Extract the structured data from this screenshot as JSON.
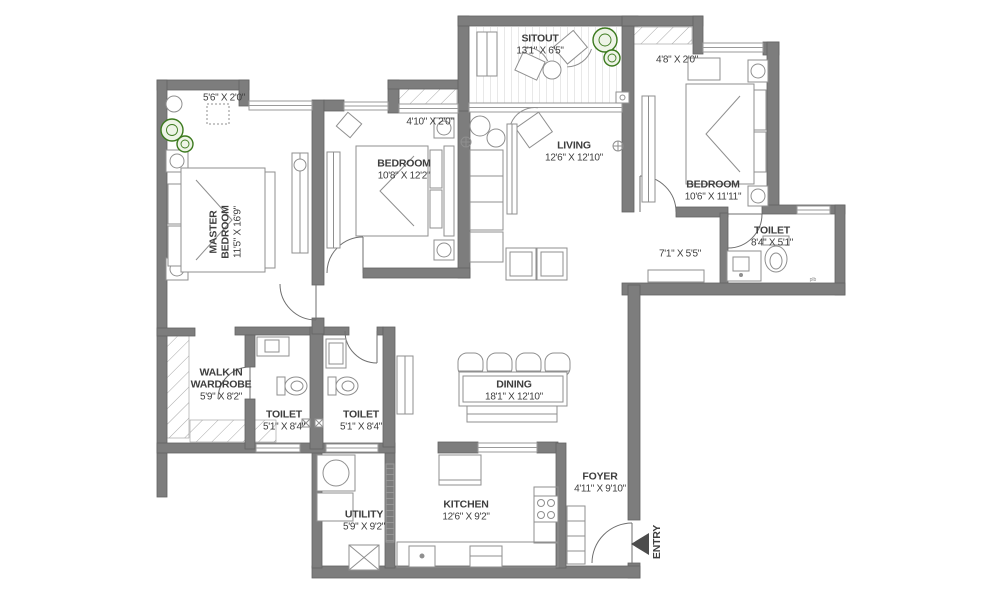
{
  "title": "Apartment floor plan",
  "rooms": {
    "master_bedroom": {
      "name": "MASTER BEDROOM",
      "dims": "11'5\" X 16'9\""
    },
    "bedroom_2": {
      "name": "BEDROOM",
      "dims": "10'8\" X 12'2\""
    },
    "bedroom_3": {
      "name": "BEDROOM",
      "dims": "10'6\" X 11'11\""
    },
    "living": {
      "name": "LIVING",
      "dims": "12'6\" X 12'10\""
    },
    "sitout": {
      "name": "SITOUT",
      "dims": "13'1\" X 6'5\""
    },
    "dining": {
      "name": "DINING",
      "dims": "18'1\" X 12'10\""
    },
    "kitchen": {
      "name": "KITCHEN",
      "dims": "12'6\" X 9'2\""
    },
    "utility": {
      "name": "UTILITY",
      "dims": "5'9\" X 9'2\""
    },
    "foyer": {
      "name": "FOYER",
      "dims": "4'11\" X 9'10\""
    },
    "walk_in_wardrobe": {
      "name": "WALK IN WARDROBE",
      "dims": "5'9\" X 8'2\""
    },
    "toilet_1": {
      "name": "TOILET",
      "dims": "5'1\" X 8'4\""
    },
    "toilet_2": {
      "name": "TOILET",
      "dims": "5'1\" X 8'4\""
    },
    "toilet_3": {
      "name": "TOILET",
      "dims": "8'4\" X 5'1\""
    },
    "passage": {
      "dims": "7'1\" X 5'5\""
    },
    "balcony_master": {
      "dims": "5'6\" X 2'0\""
    },
    "balcony_bedroom2": {
      "dims": "4'10\" X 2'0\""
    },
    "balcony_bedroom3": {
      "dims": "4'8\" X 2'0\""
    }
  },
  "entry": {
    "label": "ENTRY"
  },
  "annotations": {
    "plumbing": "plb"
  },
  "colors": {
    "wall": "#7d7d7d",
    "wall_edge": "#636363",
    "text": "#3e3e3e",
    "furniture_line": "#8f8f8f",
    "plant_green": "#3c7a1e",
    "deck_stripe": "#d9d9d9"
  }
}
